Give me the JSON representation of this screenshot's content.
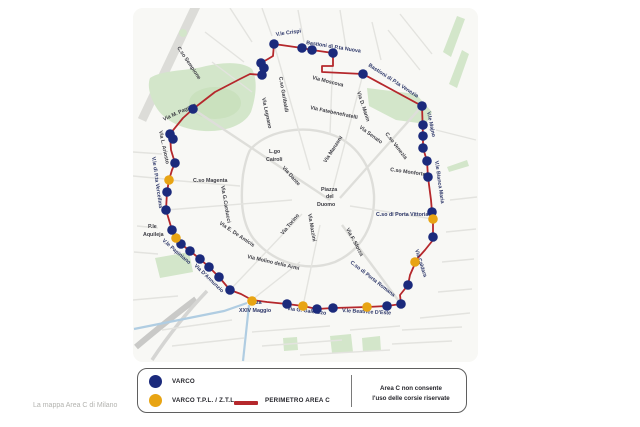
{
  "caption": "La mappa Area C di Milano",
  "legend": {
    "varco_label": "VARCO",
    "varco_tpl_label": "VARCO T.P.L. / Z.T.L.",
    "perimeter_label": "PERIMETRO AREA C",
    "note": "Area C non consente\nl'uso delle corsie riservate"
  },
  "colors": {
    "varco": "#1b2a7c",
    "tpl": "#e8a413",
    "per": "#b5282c"
  },
  "map": {
    "perimeter": [
      [
        193,
        109
      ],
      [
        215,
        92
      ],
      [
        240,
        79
      ],
      [
        250,
        74
      ],
      [
        262,
        75
      ],
      [
        264,
        68
      ],
      [
        261,
        63
      ],
      [
        268,
        59
      ],
      [
        273,
        56
      ],
      [
        274,
        44
      ],
      [
        302,
        48
      ],
      [
        312,
        50
      ],
      [
        333,
        53
      ],
      [
        333,
        66
      ],
      [
        322,
        66
      ],
      [
        322,
        72
      ],
      [
        363,
        74
      ],
      [
        422,
        106
      ],
      [
        423,
        136
      ],
      [
        423,
        148
      ],
      [
        427,
        161
      ],
      [
        428,
        177
      ],
      [
        431,
        200
      ],
      [
        432,
        212
      ],
      [
        433,
        219
      ],
      [
        433,
        240
      ],
      [
        425,
        250
      ],
      [
        417,
        259
      ],
      [
        410,
        275
      ],
      [
        408,
        285
      ],
      [
        400,
        295
      ],
      [
        401,
        304
      ],
      [
        387,
        306
      ],
      [
        367,
        307
      ],
      [
        333,
        308
      ],
      [
        317,
        309
      ],
      [
        303,
        306
      ],
      [
        287,
        304
      ],
      [
        267,
        302
      ],
      [
        252,
        300
      ],
      [
        241,
        294
      ],
      [
        230,
        290
      ],
      [
        219,
        277
      ],
      [
        209,
        267
      ],
      [
        200,
        259
      ],
      [
        190,
        251
      ],
      [
        181,
        244
      ],
      [
        176,
        238
      ],
      [
        172,
        230
      ],
      [
        166,
        210
      ],
      [
        167,
        192
      ],
      [
        169,
        180
      ],
      [
        172,
        170
      ],
      [
        175,
        163
      ],
      [
        171,
        150
      ],
      [
        170,
        134
      ],
      [
        183,
        118
      ]
    ],
    "varchi": [
      {
        "x": 193,
        "y": 109,
        "k": "b"
      },
      {
        "x": 262,
        "y": 75,
        "k": "b"
      },
      {
        "x": 264,
        "y": 68,
        "k": "b"
      },
      {
        "x": 261,
        "y": 63,
        "k": "b"
      },
      {
        "x": 274,
        "y": 44,
        "k": "b"
      },
      {
        "x": 302,
        "y": 48,
        "k": "b"
      },
      {
        "x": 312,
        "y": 50,
        "k": "b"
      },
      {
        "x": 333,
        "y": 53,
        "k": "b"
      },
      {
        "x": 363,
        "y": 74,
        "k": "b"
      },
      {
        "x": 422,
        "y": 106,
        "k": "b"
      },
      {
        "x": 423,
        "y": 125,
        "k": "b"
      },
      {
        "x": 423,
        "y": 136,
        "k": "b"
      },
      {
        "x": 423,
        "y": 148,
        "k": "b"
      },
      {
        "x": 427,
        "y": 161,
        "k": "b"
      },
      {
        "x": 428,
        "y": 177,
        "k": "b"
      },
      {
        "x": 432,
        "y": 212,
        "k": "b"
      },
      {
        "x": 433,
        "y": 219,
        "k": "y"
      },
      {
        "x": 433,
        "y": 237,
        "k": "b"
      },
      {
        "x": 415,
        "y": 262,
        "k": "y"
      },
      {
        "x": 408,
        "y": 285,
        "k": "b"
      },
      {
        "x": 401,
        "y": 304,
        "k": "b"
      },
      {
        "x": 387,
        "y": 306,
        "k": "b"
      },
      {
        "x": 367,
        "y": 307,
        "k": "y"
      },
      {
        "x": 333,
        "y": 308,
        "k": "b"
      },
      {
        "x": 317,
        "y": 309,
        "k": "b"
      },
      {
        "x": 303,
        "y": 306,
        "k": "y"
      },
      {
        "x": 287,
        "y": 304,
        "k": "b"
      },
      {
        "x": 252,
        "y": 301,
        "k": "y"
      },
      {
        "x": 230,
        "y": 290,
        "k": "b"
      },
      {
        "x": 219,
        "y": 277,
        "k": "b"
      },
      {
        "x": 209,
        "y": 267,
        "k": "b"
      },
      {
        "x": 200,
        "y": 259,
        "k": "b"
      },
      {
        "x": 190,
        "y": 251,
        "k": "b"
      },
      {
        "x": 181,
        "y": 244,
        "k": "b"
      },
      {
        "x": 176,
        "y": 238,
        "k": "y"
      },
      {
        "x": 172,
        "y": 230,
        "k": "b"
      },
      {
        "x": 166,
        "y": 210,
        "k": "b"
      },
      {
        "x": 167,
        "y": 192,
        "k": "b"
      },
      {
        "x": 169,
        "y": 180,
        "k": "y"
      },
      {
        "x": 175,
        "y": 163,
        "k": "b"
      },
      {
        "x": 170,
        "y": 134,
        "k": "b"
      },
      {
        "x": 173,
        "y": 139,
        "k": "b"
      }
    ],
    "labels": [
      {
        "t": "C.so Sempione",
        "x": 177,
        "y": 48,
        "r": 56,
        "c": "s"
      },
      {
        "t": "Via M. Pagano",
        "x": 164,
        "y": 121,
        "r": -25,
        "c": "s"
      },
      {
        "t": "V.le Crispi",
        "x": 276,
        "y": 36,
        "r": -8,
        "c": "p"
      },
      {
        "t": "Bastioni di P.ta Nuova",
        "x": 306,
        "y": 44,
        "r": 9,
        "c": "p"
      },
      {
        "t": "Bastioni di P.ta Venezia",
        "x": 368,
        "y": 66,
        "r": 33,
        "c": "p"
      },
      {
        "t": "Via Moscova",
        "x": 312,
        "y": 79,
        "r": 14,
        "c": "s"
      },
      {
        "t": "Via Fatebenefratelli",
        "x": 310,
        "y": 109,
        "r": 12,
        "c": "s"
      },
      {
        "t": "Via D. Manin",
        "x": 357,
        "y": 92,
        "r": 72,
        "c": "s"
      },
      {
        "t": "C.so Garibaldi",
        "x": 279,
        "y": 77,
        "r": 80,
        "c": "s"
      },
      {
        "t": "Via Legnano",
        "x": 262,
        "y": 98,
        "r": 78,
        "c": "s"
      },
      {
        "t": "Via L. Ariosto",
        "x": 159,
        "y": 131,
        "r": 78,
        "c": "s"
      },
      {
        "t": "V.le di P.ta Vercellina",
        "x": 152,
        "y": 157,
        "r": 82,
        "c": "p"
      },
      {
        "t": "C.so Magenta",
        "x": 193,
        "y": 182,
        "r": 0,
        "c": "s"
      },
      {
        "t": "Via G.Carducci",
        "x": 221,
        "y": 186,
        "r": 80,
        "c": "s"
      },
      {
        "t": "P.le",
        "x": 148,
        "y": 228,
        "r": 0,
        "c": "s"
      },
      {
        "t": "Aquileja",
        "x": 143,
        "y": 236,
        "r": 0,
        "c": "s"
      },
      {
        "t": "V.le Papiniano",
        "x": 162,
        "y": 241,
        "r": 41,
        "c": "p"
      },
      {
        "t": "Via E. De Amicis",
        "x": 219,
        "y": 224,
        "r": 34,
        "c": "s"
      },
      {
        "t": "Via Molino delle Armi",
        "x": 247,
        "y": 258,
        "r": 13,
        "c": "s"
      },
      {
        "t": "Via D'Annunzio",
        "x": 194,
        "y": 266,
        "r": 44,
        "c": "p"
      },
      {
        "t": "P.zza",
        "x": 249,
        "y": 304,
        "r": 0,
        "c": "p"
      },
      {
        "t": "XXIV Maggio",
        "x": 239,
        "y": 312,
        "r": 0,
        "c": "p"
      },
      {
        "t": "Via G. Galeazzo",
        "x": 287,
        "y": 310,
        "r": 7,
        "c": "p"
      },
      {
        "t": "V.le Beatrice D'Este",
        "x": 342,
        "y": 312,
        "r": 3,
        "c": "p"
      },
      {
        "t": "C.so di Porta Romana",
        "x": 350,
        "y": 263,
        "r": 38,
        "c": "p"
      },
      {
        "t": "Via Caldara",
        "x": 415,
        "y": 250,
        "r": 72,
        "c": "p"
      },
      {
        "t": "C.so di Porta Vittoria",
        "x": 376,
        "y": 216,
        "r": 0,
        "c": "p"
      },
      {
        "t": "V.le Bianca Maria",
        "x": 435,
        "y": 161,
        "r": 82,
        "c": "p"
      },
      {
        "t": "C.so Monforte",
        "x": 390,
        "y": 171,
        "r": 8,
        "c": "s"
      },
      {
        "t": "V.le Majno",
        "x": 427,
        "y": 112,
        "r": 78,
        "c": "p"
      },
      {
        "t": "Via Senato",
        "x": 359,
        "y": 128,
        "r": 36,
        "c": "s"
      },
      {
        "t": "C.so Venezia",
        "x": 385,
        "y": 134,
        "r": 52,
        "c": "s"
      },
      {
        "t": "L.go",
        "x": 269,
        "y": 153,
        "r": 0,
        "c": "s"
      },
      {
        "t": "Cairoli",
        "x": 266,
        "y": 161,
        "r": 0,
        "c": "s"
      },
      {
        "t": "Via Dante",
        "x": 282,
        "y": 168,
        "r": 48,
        "c": "s"
      },
      {
        "t": "Via Manzoni",
        "x": 326,
        "y": 163,
        "r": -57,
        "c": "s"
      },
      {
        "t": "Via Torino",
        "x": 283,
        "y": 235,
        "r": -50,
        "c": "s"
      },
      {
        "t": "Via Mazzini",
        "x": 308,
        "y": 214,
        "r": 80,
        "c": "s"
      },
      {
        "t": "Via F. Sforza",
        "x": 346,
        "y": 229,
        "r": 62,
        "c": "s"
      },
      {
        "t": "Piazza",
        "x": 321,
        "y": 191,
        "r": 0,
        "c": "s"
      },
      {
        "t": "del",
        "x": 326,
        "y": 198,
        "r": 0,
        "c": "s"
      },
      {
        "t": "Duomo",
        "x": 317,
        "y": 206,
        "r": 0,
        "c": "s"
      }
    ]
  }
}
